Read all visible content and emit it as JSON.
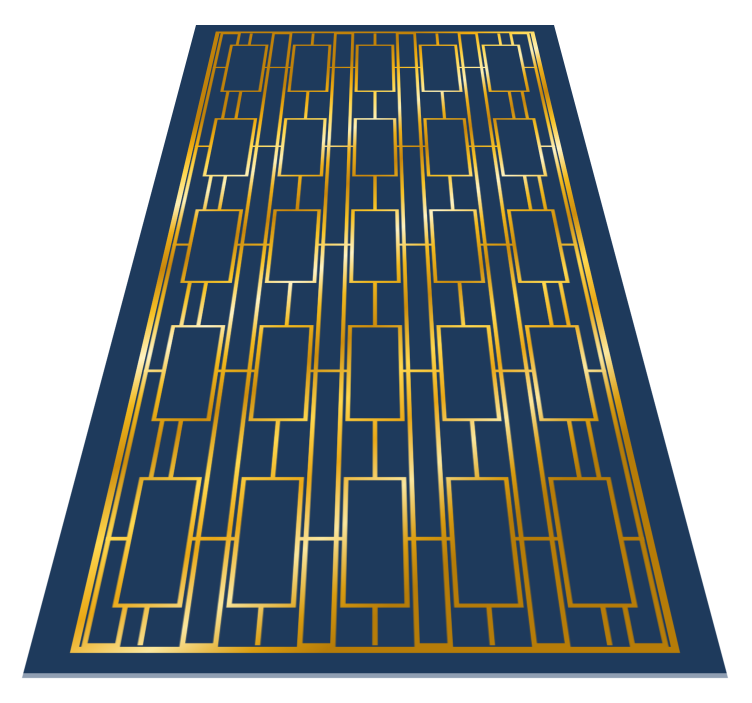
{
  "scene": {
    "background": "#ffffff",
    "alt": "Navy blue and gold Art Deco geometric runner rug shown lying flat in receding floor perspective"
  },
  "rug": {
    "colors": {
      "navy": "#1e3a5c",
      "bottom_edge": "#a5b2c2",
      "gold_gradient_stops": [
        [
          "0.00",
          "#c0820a"
        ],
        [
          "0.07",
          "#f0ad12"
        ],
        [
          "0.13",
          "#ffd74e"
        ],
        [
          "0.20",
          "#fdf0b6"
        ],
        [
          "0.26",
          "#edb01a"
        ],
        [
          "0.33",
          "#c8860c"
        ],
        [
          "0.41",
          "#f7c327"
        ],
        [
          "0.48",
          "#fff3c4"
        ],
        [
          "0.55",
          "#f2ba1e"
        ],
        [
          "0.63",
          "#cd8d0d"
        ],
        [
          "0.72",
          "#ffd84f"
        ],
        [
          "0.80",
          "#eaa816"
        ],
        [
          "0.88",
          "#fbe79e"
        ],
        [
          "0.95",
          "#d99c10"
        ],
        [
          "1.00",
          "#b67c08"
        ]
      ]
    },
    "geometry": {
      "flat_width": 706,
      "flat_height": 1614,
      "margin_x": 46,
      "margin_y": 36,
      "frame_stroke": 8,
      "pattern_stroke": 5.5,
      "columns": 5,
      "rows": 5,
      "big_rect_w": 68,
      "big_rect_h": 198,
      "gutter_rect_w": 34,
      "edge_gutter_center_inset": 72,
      "bottom_edge_strip_h": 6
    },
    "projection": {
      "perspective_px": 1000,
      "rotate_x_deg": 37.05,
      "bottom_y": 678,
      "center_x": 375
    }
  }
}
